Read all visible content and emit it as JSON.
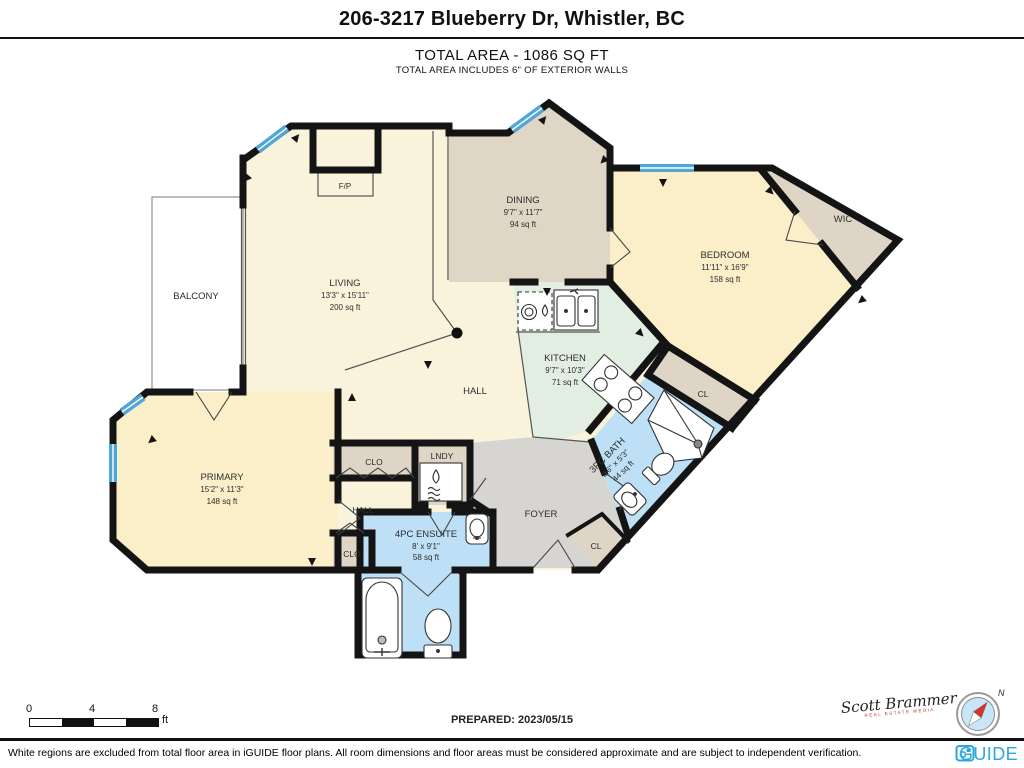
{
  "header": {
    "title": "206-3217 Blueberry Dr, Whistler, BC",
    "total_area": "TOTAL AREA - 1086 SQ FT",
    "subtitle": "TOTAL AREA INCLUDES 6\" OF EXTERIOR WALLS"
  },
  "rooms": {
    "living": {
      "name": "LIVING",
      "dims": "13'3\" x 15'11\"",
      "area": "200 sq ft"
    },
    "dining": {
      "name": "DINING",
      "dims": "9'7\" x 11'7\"",
      "area": "94 sq ft"
    },
    "bedroom": {
      "name": "BEDROOM",
      "dims": "11'11\" x 16'9\"",
      "area": "158 sq ft"
    },
    "kitchen": {
      "name": "KITCHEN",
      "dims": "9'7\" x 10'3\"",
      "area": "71 sq ft"
    },
    "primary": {
      "name": "PRIMARY",
      "dims": "15'2\" x 11'3\"",
      "area": "148 sq ft"
    },
    "ensuite": {
      "name": "4PC ENSUITE",
      "dims": "8' x 9'1\"",
      "area": "58 sq ft"
    },
    "bath": {
      "name": "3PC BATH",
      "dims": "8'6\" x 5'3\"",
      "area": "44 sq ft"
    }
  },
  "labels": {
    "balcony": "BALCONY",
    "fp": "F/P",
    "wic": "WIC",
    "hall_main": "HALL",
    "hall_lower": "HALL",
    "lndy": "LNDY",
    "clo_top": "CLO",
    "clo_bottom": "CLO",
    "cl_bedroom": "CL",
    "cl_foyer": "CL",
    "foyer": "FOYER"
  },
  "footer": {
    "scale": {
      "t0": "0",
      "t4": "4",
      "t8": "8",
      "unit": "ft"
    },
    "prepared": "PREPARED: 2023/05/15",
    "signature": "Scott Brammer",
    "signature_sub": "REAL ESTATE MEDIA",
    "compass_north": "N",
    "disclaimer": "White regions are excluded from total floor area in iGUIDE floor plans. All room dimensions and floor areas must be considered approximate and are subject to independent verification.",
    "brand": "iGUIDE"
  },
  "colors": {
    "wall": "#141414",
    "window_blue": "#4fa6d8",
    "floor_cream": "#faf3dc",
    "floor_yellow": "#fbefc9",
    "dining_taupe": "#dfd6c5",
    "closet_beige": "#ded5c6",
    "kitchen_mint": "#e3eee2",
    "bath_blue": "#bee0f6",
    "foyer_gray": "#d7d5d2",
    "brand_blue": "#2ea7e0"
  }
}
